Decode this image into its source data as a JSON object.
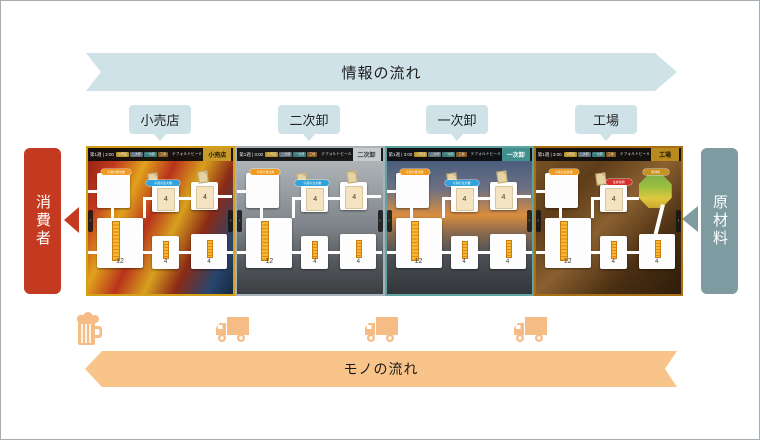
{
  "diagram": {
    "info_flow": "情報の流れ",
    "goods_flow": "モノの流れ",
    "consumer": "消費者",
    "raw_material": "原材料",
    "stations": [
      "小売店",
      "二次卸",
      "一次卸",
      "工場"
    ]
  },
  "colors": {
    "info_arrow": "#cfe2e7",
    "goods_arrow": "#f9c489",
    "consumer_red": "#c43a20",
    "raw_material_slate": "#7e9ba1",
    "icon_peach": "#f5bc85"
  },
  "icons": {
    "consumer_side": "beer-mug",
    "between_panels": "delivery-truck"
  },
  "station_chips": [
    {
      "label": "小売店",
      "color": "#b8942a"
    },
    {
      "label": "二次卸",
      "color": "#5f6f78"
    },
    {
      "label": "一次卸",
      "color": "#3d7b7b"
    },
    {
      "label": "工場",
      "color": "#8a5c20"
    }
  ],
  "panels": [
    {
      "key": "retail",
      "type": "normal",
      "bg": "retail",
      "station": "小売店",
      "header": {
        "time_label": "第1週 | 3:00",
        "company": "デフォルトビール会社"
      },
      "pills": {
        "order": "今週の発注数",
        "incoming": "今週の注文書"
      },
      "values": {
        "order_card": "4",
        "transit_card": "4",
        "stock": "12",
        "ship_mid": "4",
        "ship_right": "4"
      },
      "colors": {
        "border": "#d4a017",
        "chip_bg": "#c9992a",
        "chip_text": "#241b07"
      }
    },
    {
      "key": "secondary-wholesaler",
      "type": "normal",
      "bg": "wholesale2",
      "station": "二次卸",
      "header": {
        "time_label": "第1週 | 3:00",
        "company": "デフォルトビール会社"
      },
      "pills": {
        "order": "今週の発注数",
        "incoming": "今週の注文書"
      },
      "values": {
        "order_card": "4",
        "transit_card": "4",
        "stock": "12",
        "ship_mid": "4",
        "ship_right": "4"
      },
      "colors": {
        "border": "#a8b2b8",
        "chip_bg": "#c6ccce",
        "chip_text": "#2e3438"
      }
    },
    {
      "key": "primary-wholesaler",
      "type": "normal",
      "bg": "wholesale1",
      "station": "一次卸",
      "header": {
        "time_label": "第1週 | 3:00",
        "company": "デフォルトビール会社"
      },
      "pills": {
        "order": "今週の発注数",
        "incoming": "今週の注文書"
      },
      "values": {
        "order_card": "4",
        "transit_card": "4",
        "stock": "12",
        "ship_mid": "4",
        "ship_right": "4"
      },
      "colors": {
        "border": "#5fa3a3",
        "chip_bg": "#418f8f",
        "chip_text": "#ffffff"
      }
    },
    {
      "key": "factory",
      "type": "factory",
      "bg": "factory",
      "station": "工場",
      "header": {
        "time_label": "第1週 | 3:00",
        "company": "デフォルトビール会社"
      },
      "pills": {
        "order": "今週の生産数",
        "production": "生産依頼",
        "material": "原材料"
      },
      "values": {
        "order_card": "4",
        "stock": "12",
        "ship_mid": "4",
        "ship_right": "4"
      },
      "colors": {
        "border": "#a86e14",
        "chip_bg": "#b98a1e",
        "chip_text": "#241b07"
      }
    }
  ]
}
